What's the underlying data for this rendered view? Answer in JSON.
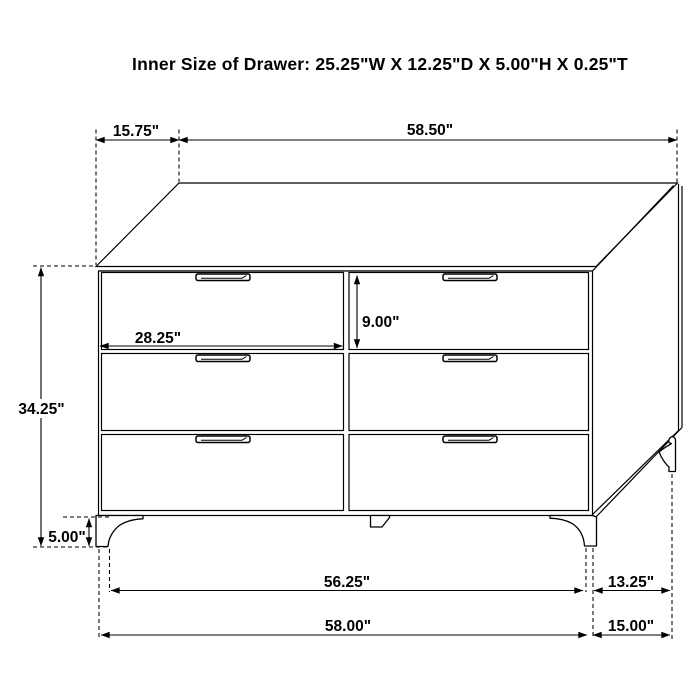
{
  "page": {
    "background": "#ffffff",
    "line_color": "#000000",
    "text_color": "#000000"
  },
  "title": "Inner Size of Drawer: 25.25\"W X 12.25\"D X 5.00\"H X 0.25\"T",
  "dimensions": {
    "top_depth_offset": "15.75\"",
    "top_width": "58.50\"",
    "drawer_opening_width": "28.25\"",
    "drawer_opening_height": "9.00\"",
    "overall_height": "34.25\"",
    "leg_height": "5.00\"",
    "width_between_legs": "56.25\"",
    "leg_depth_spacing": "13.25\"",
    "base_width": "58.00\"",
    "overall_depth": "15.00\""
  }
}
